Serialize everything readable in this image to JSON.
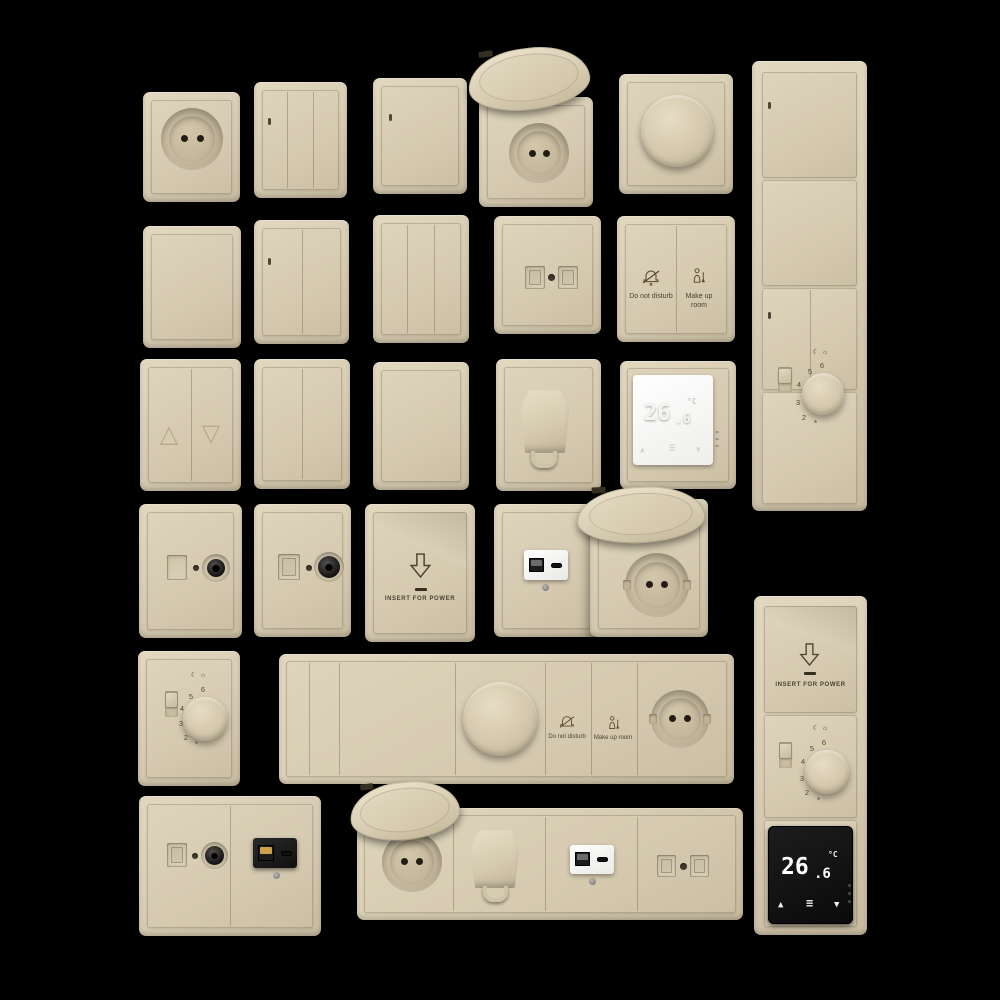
{
  "scene": {
    "background": "#000000",
    "plate_color": "#d8cdb4",
    "plate_highlight": "#e3d9c1",
    "plate_shadow": "#b9ad92",
    "seam_color": "#8d8168",
    "display_black": "#151515",
    "display_white": "#ffffff"
  },
  "labels": {
    "do_not_disturb": "Do not disturb",
    "make_up_room": "Make up room",
    "insert_for_power": "INSERT FOR POWER"
  },
  "display": {
    "value": "26",
    "decimal": ".6",
    "unit": "°C",
    "up": "▲",
    "down": "▼",
    "menu": "≡"
  },
  "dial": {
    "n6": "6",
    "n5": "5",
    "n4": "4",
    "n3": "3",
    "n2": "2",
    "night": "☾",
    "day": "☼",
    "frost": "*"
  },
  "blinds": {
    "up": "△",
    "down": "▽"
  }
}
